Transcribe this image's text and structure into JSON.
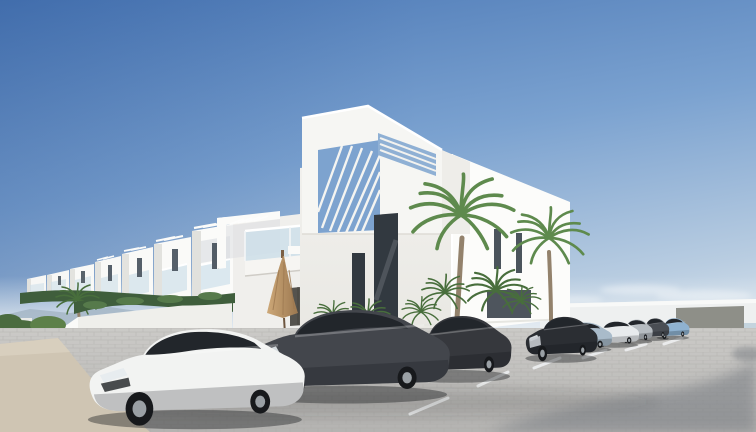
{
  "scene": {
    "type": "architectural-render",
    "description": "3D render of a modern white Mediterranean apartment complex with rooftop pergola tower, glass balconies, a closed tan patio umbrella, tall palm trees, green hedges on white planter walls, and a paved parking lot with a diagonal row of parked cars under a clear blue sky.",
    "objects": [
      {
        "name": "sky",
        "detail": "clear gradient sky, darker blue upper-left fading to pale haze at horizon"
      },
      {
        "name": "main-building",
        "detail": "white cubic two-storey building with rooftop tower and louvered pergola openings"
      },
      {
        "name": "townhouse-row",
        "detail": "identical white townhouses with balconies receding to the left"
      },
      {
        "name": "balcony",
        "detail": "glass-railing balcony with white outdoor cushions"
      },
      {
        "name": "umbrella",
        "detail": "closed tan patio umbrella on ground-floor terrace"
      },
      {
        "name": "palm-trees",
        "detail": "two tall fan palms in front of the right facade plus low palm shrubs"
      },
      {
        "name": "planter-wall",
        "detail": "low white wall topped with a green hedge, sandy path at lower left"
      },
      {
        "name": "background-wall",
        "detail": "low white perimeter wall with gray gate panel at right"
      },
      {
        "name": "parking-lot",
        "detail": "gray brick-paver lot with white bay lines and a large soft shadow at lower right"
      },
      {
        "name": "car-row",
        "detail": "nine cars parked diagonally: white coupe in front, dark gray sedans, then silver, white and light blue cars receding"
      }
    ]
  },
  "colors": {
    "sky_top": "#4a77b5",
    "sky_mid": "#7ba2d0",
    "sky_low": "#b9cde1",
    "sky_horizon": "#e2eaf0",
    "hills": "#a4b6c6",
    "building_bright": "#fcfcfa",
    "building_light": "#f2f1ee",
    "building_shaded": "#e9e8e3",
    "tower_face": "#f6f6f3",
    "opening_sky": "#7da3cf",
    "window_dark": "#323940",
    "window_slit": "#4b545c",
    "balcony_glass": "#cadeea",
    "garage_door": "#55534e",
    "umbrella_light": "#cda878",
    "umbrella_dark": "#9c7850",
    "umbrella_pole": "#6e563f",
    "palm_green": "#5e8a4d",
    "palm_green_dark": "#486e3c",
    "palm_trunk": "#93826c",
    "hedge": "#3f5e3c",
    "bush_red": "#a8633c",
    "sand": "#cfc5b3",
    "wall_white": "#eef0f0",
    "wall_panel": "#8e8f88",
    "sea": "#b9cdd9",
    "pavement_far": "#cbcac7",
    "pavement_near": "#b4b3b1",
    "paver_line": "#a7a6a3",
    "parking_line": "#eef0f1",
    "shadow": "#70747c"
  },
  "cars": [
    {
      "name": "white-coupe",
      "color": "#f2f3f2"
    },
    {
      "name": "dark-gray-sedan",
      "color": "#43464c"
    },
    {
      "name": "dark-sportback",
      "color": "#36383d"
    },
    {
      "name": "black-sedan-chrome-grille",
      "color": "#2b2e33"
    },
    {
      "name": "silver-blue-sedan",
      "color": "#a9bbca"
    },
    {
      "name": "white-sedan",
      "color": "#e8ebed"
    },
    {
      "name": "silver-sedan",
      "color": "#b6bcc1"
    },
    {
      "name": "graphite-sedan",
      "color": "#4a4e54"
    },
    {
      "name": "light-blue-sedan",
      "color": "#8fb2d0"
    }
  ]
}
